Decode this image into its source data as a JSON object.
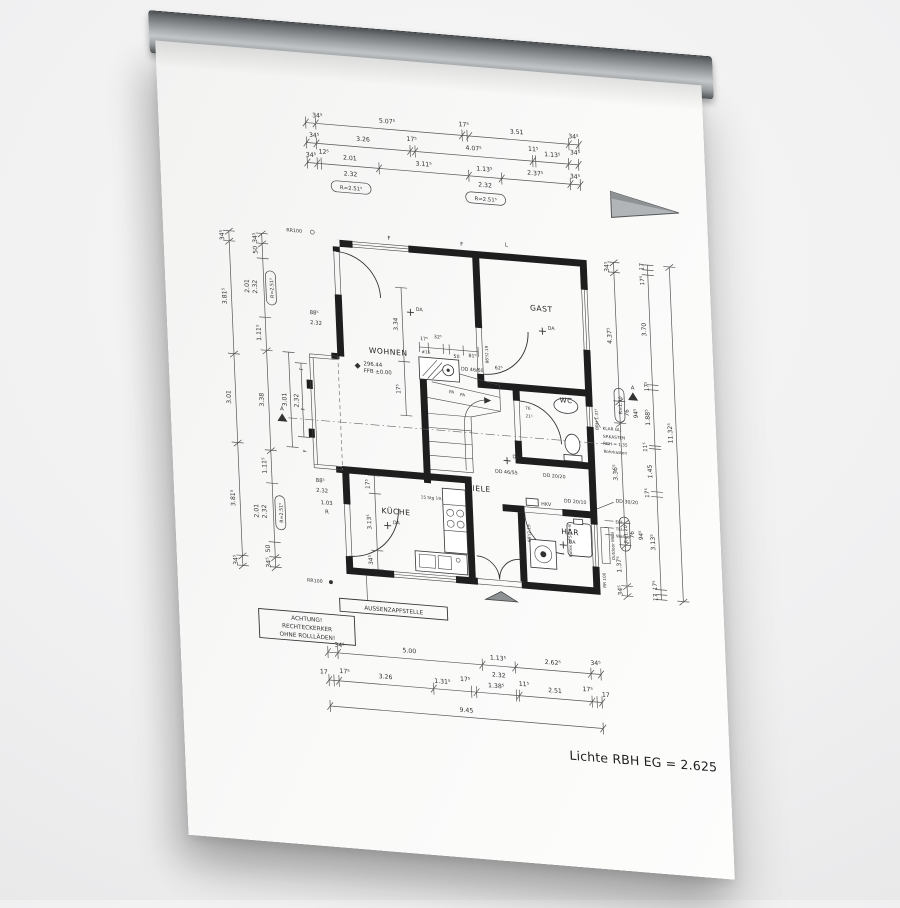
{
  "caption": "Lichte RBH EG = 2.625",
  "boxes": {
    "warning1": "ACHTUNG!",
    "warning2": "RECHTECKERKER",
    "warning3": "OHNE ROLLLÄDEN!",
    "tap": "AUSSENZAPFSTELLE"
  },
  "rooms": {
    "wohnen": "WOHNEN",
    "gast": "GAST",
    "kueche": "KÜCHE",
    "diele": "DIELE",
    "wc": "WC",
    "har": "HAR"
  },
  "level": {
    "value": "296.44",
    "ffb": "FFB ±0.00"
  },
  "stair": {
    "note": "15 Stg 19.0/25.0",
    "pa1": "PA",
    "pa2": "PA",
    "id": "#16"
  },
  "fixtures": {
    "rotex": "Rotex HFSU 6-8"
  },
  "notes": {
    "dd4660": "DD 46/60",
    "dd4655": "DD 46/55",
    "dd2020": "DD 20/20",
    "dd2010": "DD 20/10",
    "dd3020": "DD 30/20",
    "hkv": "HKV",
    "elt": "ELT",
    "tel": "TEL",
    "wasser": "Wasser",
    "klargl": "KLAR GL.",
    "spkasten": "SP.KASTEN",
    "rbh135": "RBH = 1.35",
    "rohrkasten": "Rohrkasten",
    "rr100a": "RR100",
    "rr100b": "RR100",
    "rr100r": "RR 100",
    "outdoor": "Outdoor Möbl",
    "brh": "BRH 1.37⁵",
    "door_size": "88⁵/2.19",
    "d62": "62⁵",
    "w76": "76",
    "w215": "21⁵",
    "f": "F",
    "l": "L",
    "a": "A",
    "da": "DA"
  },
  "dims": {
    "top1": [
      "34⁵",
      "5.07⁵",
      "17⁵",
      "3.51",
      "34⁵"
    ],
    "top2": [
      "34⁵",
      "3.26",
      "17⁵",
      "4.07⁵",
      "11⁵",
      "1.13⁵",
      "34⁵"
    ],
    "top3": [
      "34⁵",
      "12⁵",
      "2.01",
      "2.32",
      "R=2.51⁵",
      "3.11⁵",
      "1.13⁵",
      "2.32",
      "R=2.51⁵",
      "2.37⁵",
      "34⁵"
    ],
    "bottom1": [
      "34⁵",
      "5.00",
      "1.13⁵",
      "2.32",
      "2.62⁵",
      "34⁵"
    ],
    "bottom2": [
      "17",
      "17⁵",
      "3.26",
      "1.31⁵",
      "17⁵",
      "1.38⁵",
      "11⁵",
      "2.51",
      "17⁵",
      "17"
    ],
    "bottom3": "9.45",
    "leftA": [
      "34⁵",
      "3.81⁵",
      "3.01",
      "3.81⁵",
      "34⁵"
    ],
    "leftB": [
      "34⁵",
      "50",
      "2.01",
      "2.32",
      "R=2.51⁵",
      "1.11⁵",
      "3.38",
      "1.11⁵",
      "2.01",
      "2.32",
      "R=2.51⁵",
      "50",
      "34⁵"
    ],
    "leftC": "3.01",
    "leftD": "2.32",
    "door_top": [
      "88⁵",
      "2.32"
    ],
    "door_kueche": [
      "88⁵",
      "2.32",
      "1.03",
      "R"
    ],
    "rightA": [
      "34⁵",
      "4.37⁵",
      "R=1.30",
      "76",
      "94⁵",
      "3.36⁵",
      "R=1.20",
      "76",
      "94⁵",
      "1.37⁵",
      "34⁵"
    ],
    "rightB": [
      "17",
      "17⁵",
      "3.70",
      "17⁵",
      "1.88⁵",
      "11⁵",
      "1.45",
      "17⁵",
      "3.13⁵",
      "17⁵",
      "17"
    ],
    "rightC": "11.32⁵",
    "wohnen_chain": [
      "17⁵",
      "32⁵",
      "50",
      "81⁵"
    ],
    "wohnen_v": [
      "3.34",
      "17⁵"
    ],
    "kueche_v": [
      "17⁵",
      "3.13⁵",
      "34⁵"
    ]
  },
  "colors": {
    "rail": "#9fa3a6",
    "paper": "#fafaf9",
    "ink": "#1e1e1e",
    "arrow_fill": "#b2b5b7"
  }
}
